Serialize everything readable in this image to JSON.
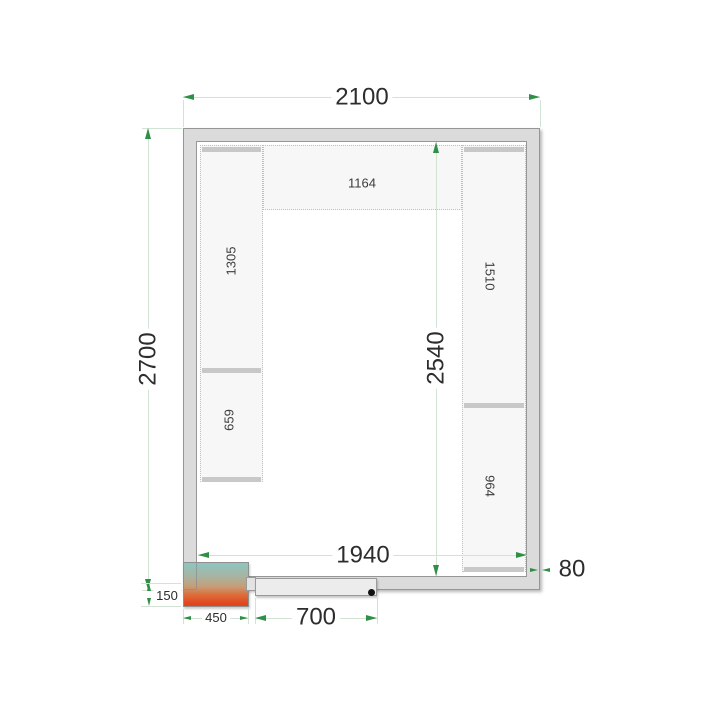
{
  "dimensions": {
    "outer_width": "2100",
    "outer_depth": "2700",
    "inner_width": "1940",
    "inner_depth": "2540",
    "wall_thickness": "80",
    "door_width": "700",
    "unit_width": "450",
    "unit_depth": "150"
  },
  "shelf_labels": {
    "top": "1164",
    "left_upper": "1305",
    "left_lower": "659",
    "right_upper": "1510",
    "right_lower": "964"
  },
  "colors": {
    "dimension_arrow_green": "#2e8f46",
    "dimension_line_green": "#d3e3d3",
    "wall_fill": "#dbdbdb",
    "wall_outline": "#969696",
    "shelf_fill": "#f7f7f7",
    "shelf_bar": "#c8c8c8",
    "unit_top_teal": "#8cc6c1",
    "unit_bottom_red": "#e2441c",
    "door_fill": "#ececec",
    "door_knob": "#111111"
  }
}
